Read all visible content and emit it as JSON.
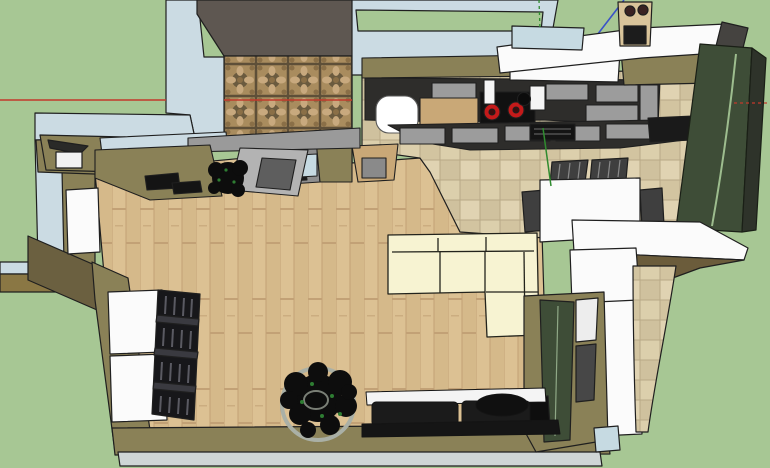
{
  "viewport": {
    "app_type": "3d-modeling-viewport",
    "style": "sketchup-like",
    "projection": "top-down birds-eye view of apartment model",
    "width_px": 770,
    "height_px": 468
  },
  "palette": {
    "background_green": "#A7C794",
    "wall_top_light_blue": "#CBDBE3",
    "glass_blue": "#C6DAE2",
    "wall_khaki": "#8A8157",
    "wall_brown_face": "#6B6040",
    "beam_tan": "#8A7744",
    "balcony_wall_gray": "#5E5751",
    "counter_dark": "#2E2D2B",
    "cabinet_gray": "#9C9C9C",
    "counter_wood": "#C9A877",
    "cooktop_black": "#111111",
    "burner_red": "#C41A1A",
    "sink_white": "#FFFFFF",
    "sofa_cream": "#F7F3D2",
    "wardrobe_green": "#3E4D37",
    "wardrobe_stripe": "#9DBD8E",
    "white_surface": "#FBFBFB",
    "chair_dark": "#3F3F3F",
    "console_black": "#1B1B1B",
    "floor_wedge_brown": "#6B5C3B",
    "bookshelf_black": "#17171A",
    "peninsula_gray": "#8E8E8E",
    "door_panel_gray": "#B3B3B3",
    "outer_trim_gray": "#CFD6D6",
    "dark_corner_gray": "#454340",
    "plant_black": "#0D0D0D",
    "plant_dot_green": "#2E7D32",
    "pot_gray": "#AAB0A6",
    "figure_tan": "#D9C49A",
    "axis_red": "#C3392B",
    "axis_green": "#2F8B2F",
    "axis_blue": "#3A52C8",
    "outline": "#1F1F1F"
  },
  "axes": {
    "red_x_axis": {
      "orientation": "horizontal",
      "y_px": 100,
      "style": "solid on left, dotted on far right"
    },
    "green_y_axis": {
      "orientation": "vertical",
      "x_px": 541,
      "style": "dotted at top edge, solid over kitchen floor"
    },
    "blue_z_axis": {
      "orientation": "diagonal",
      "style": "solid, from top edge toward model origin"
    }
  },
  "scene": {
    "rooms": [
      {
        "name": "balcony",
        "floor": "ornate patterned brown tile",
        "position": "top-left"
      },
      {
        "name": "living-room",
        "floor": "light oak plank",
        "position": "center"
      },
      {
        "name": "kitchen",
        "floor": "beige stone tile",
        "position": "top-center"
      },
      {
        "name": "dining-area",
        "floor": "beige stone tile",
        "position": "top-right"
      }
    ],
    "furniture": [
      "kitchen-counter-run-with-cooktop",
      "kitchen-sink",
      "kitchen-island-run",
      "peninsula-counter",
      "corner-shelf-with-bin",
      "white-fridge-cabinets",
      "dining-table-white",
      "dining-chairs-x4",
      "sectional-sofa-cream",
      "media-console-black",
      "bookshelf-dark",
      "tall-wardrobe-green",
      "bottom-right-cabinet-with-tv",
      "desk-with-laptop",
      "balcony-sideboard",
      "white-doors",
      "tilted-glass-door-panel",
      "potted-plant-large",
      "potted-plant-small",
      "rooftop-appliance-figure"
    ]
  }
}
